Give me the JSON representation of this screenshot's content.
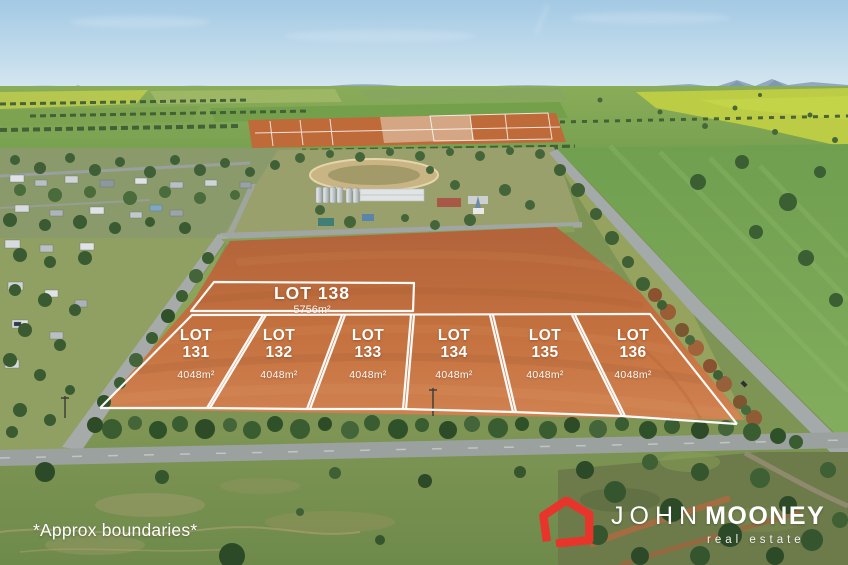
{
  "lots": [
    {
      "name": "LOT 138",
      "area": "5756m²"
    },
    {
      "name": "LOT 131",
      "area": "4048m²"
    },
    {
      "name": "LOT 132",
      "area": "4048m²"
    },
    {
      "name": "LOT 133",
      "area": "4048m²"
    },
    {
      "name": "LOT 134",
      "area": "4048m²"
    },
    {
      "name": "LOT 135",
      "area": "4048m²"
    },
    {
      "name": "LOT 136",
      "area": "4048m²"
    }
  ],
  "watermark": "*Approx boundaries*",
  "logo": {
    "name_light": "JOHN",
    "name_bold": "MOONEY",
    "tagline": "real estate",
    "icon": "house-outline-icon",
    "icon_color": "#e8352b",
    "text_color": "#ffffff"
  },
  "colors": {
    "boundary_lines": "#ffffff",
    "field_orange": "#c4713f",
    "sky_blue": "#a6cbe5"
  }
}
